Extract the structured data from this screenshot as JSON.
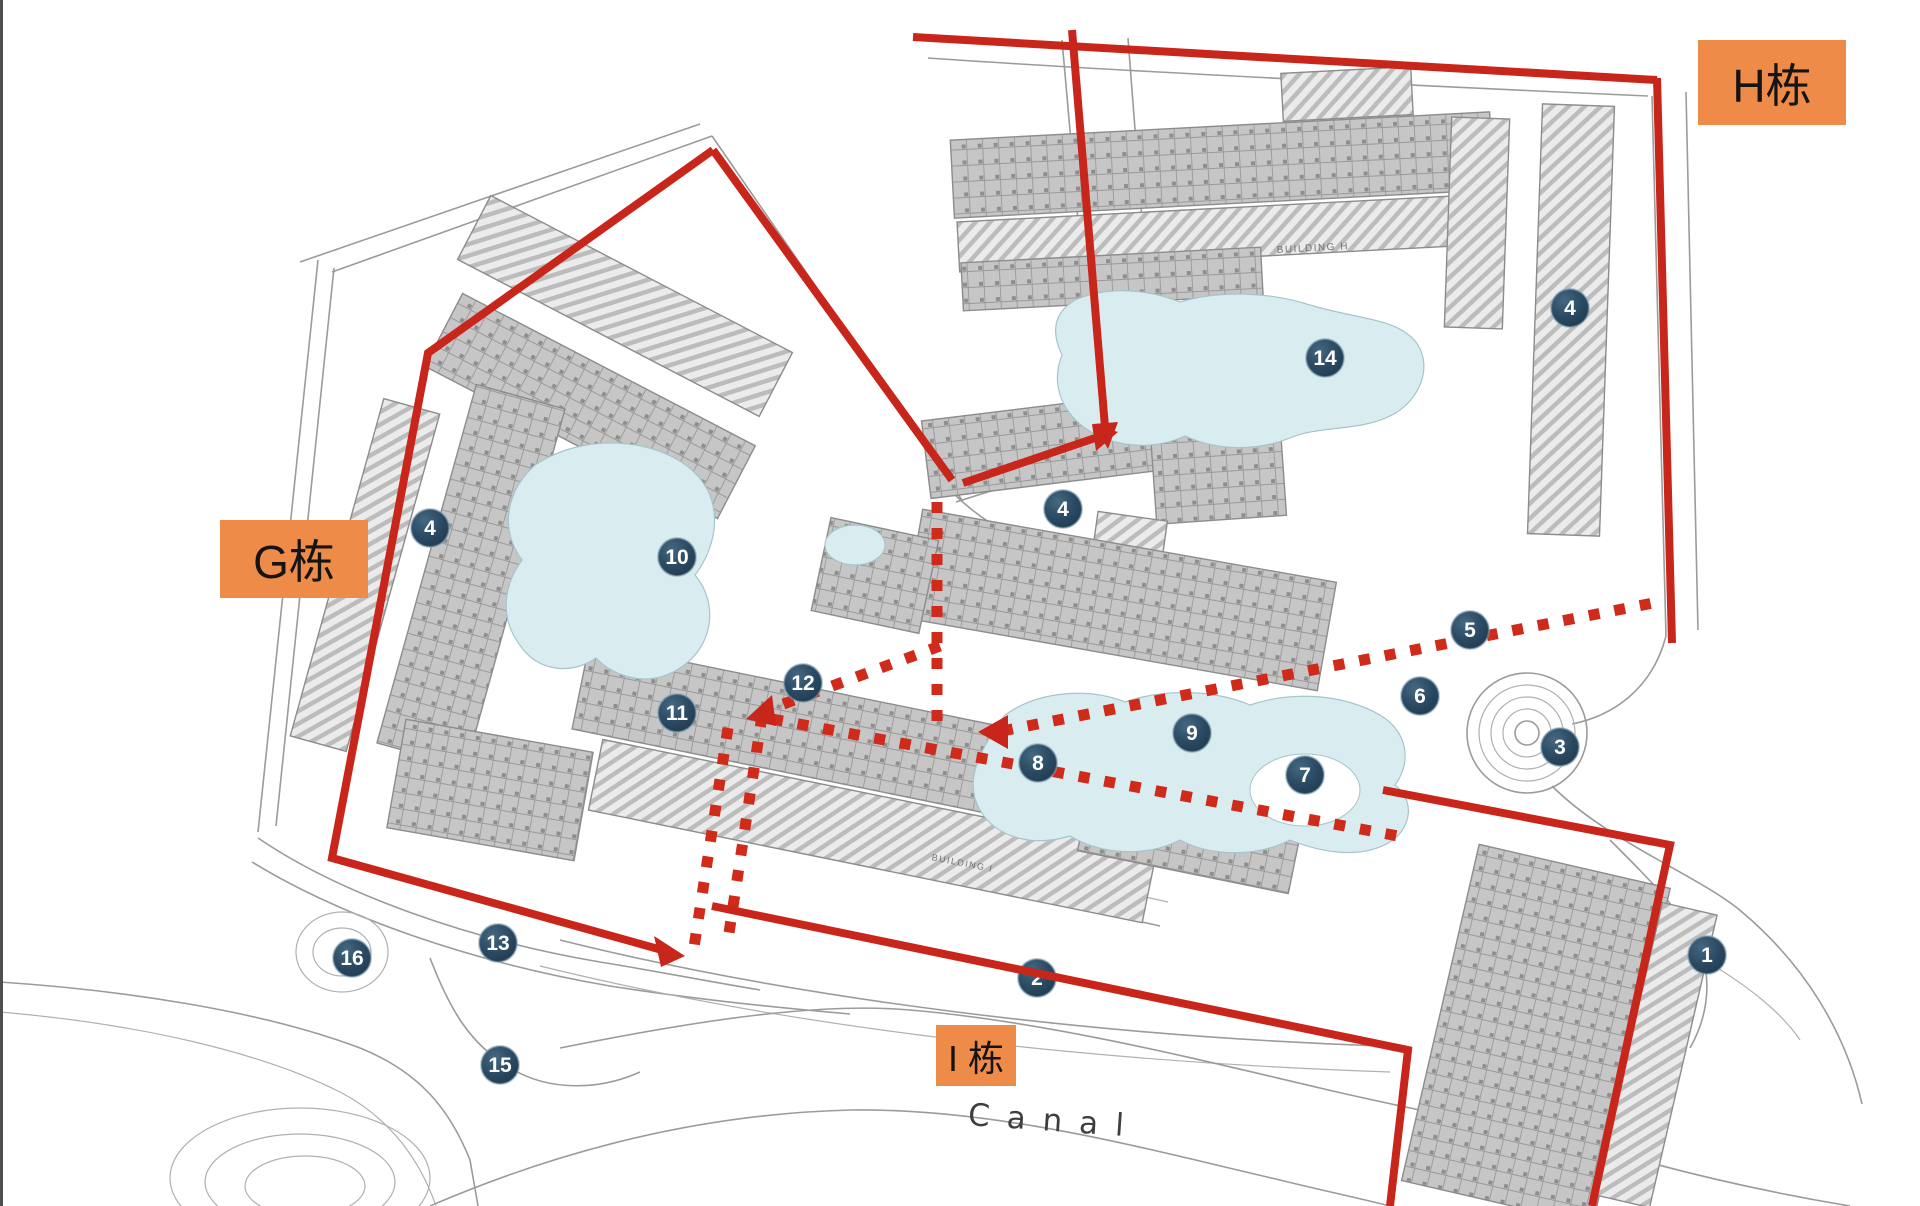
{
  "zone_labels": [
    {
      "id": "g",
      "text": "G栋"
    },
    {
      "id": "h",
      "text": "H栋"
    },
    {
      "id": "i",
      "text": "I 栋"
    }
  ],
  "markers": [
    {
      "label": "1",
      "x": 1707,
      "y": 955
    },
    {
      "label": "2",
      "x": 1037,
      "y": 978
    },
    {
      "label": "3",
      "x": 1560,
      "y": 747
    },
    {
      "label": "4",
      "x": 430,
      "y": 528
    },
    {
      "label": "4",
      "x": 1063,
      "y": 509
    },
    {
      "label": "4",
      "x": 1570,
      "y": 308
    },
    {
      "label": "5",
      "x": 1470,
      "y": 630
    },
    {
      "label": "6",
      "x": 1420,
      "y": 696
    },
    {
      "label": "7",
      "x": 1305,
      "y": 775
    },
    {
      "label": "8",
      "x": 1038,
      "y": 763
    },
    {
      "label": "9",
      "x": 1192,
      "y": 733
    },
    {
      "label": "10",
      "x": 677,
      "y": 557
    },
    {
      "label": "11",
      "x": 677,
      "y": 713
    },
    {
      "label": "12",
      "x": 803,
      "y": 683
    },
    {
      "label": "13",
      "x": 498,
      "y": 943
    },
    {
      "label": "14",
      "x": 1325,
      "y": 358
    },
    {
      "label": "15",
      "x": 500,
      "y": 1065
    },
    {
      "label": "16",
      "x": 352,
      "y": 958
    }
  ],
  "plan_texts": {
    "canal": "Canal",
    "building_h": "BUILDING H",
    "building_i": "BUILDING I"
  },
  "colors": {
    "accent_orange": "#EF8B48",
    "boundary_red": "#C9261B",
    "dotted_red": "#CF2A1A",
    "marker_navy": "#2B4A63",
    "pool_blue": "#D9EDF1"
  }
}
